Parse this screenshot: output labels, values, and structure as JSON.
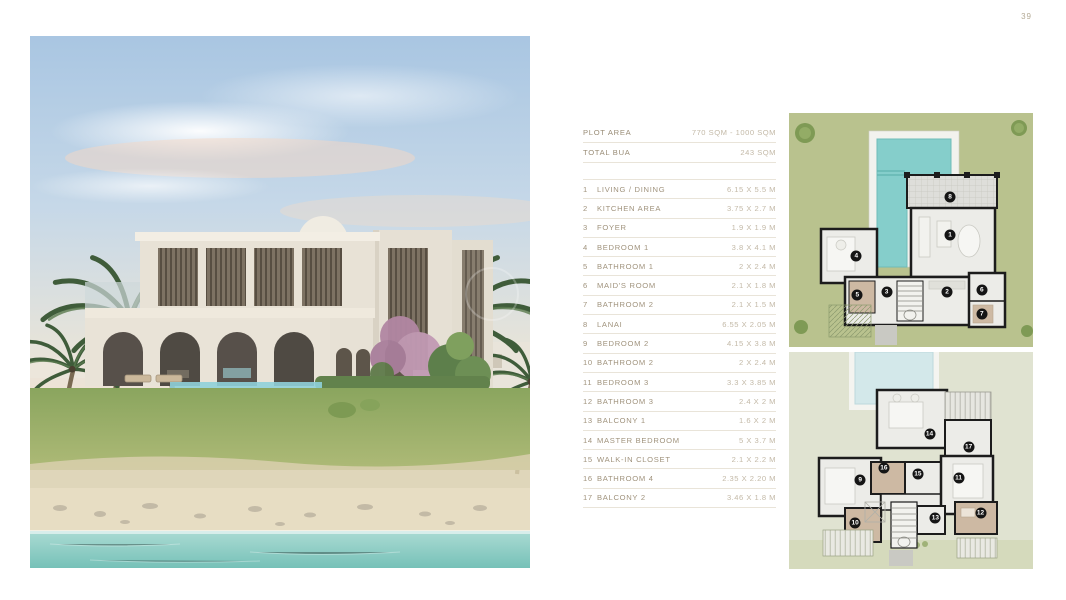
{
  "page": {
    "number": "39"
  },
  "colors": {
    "accent": "#a0937d",
    "value": "#c3b9a7",
    "divider": "#e9e4d9",
    "summary": "#998c76",
    "plan_grass": "#b9c28e",
    "plan_upper_bg": "#e0e3d1",
    "pool_teal": "#85cecb",
    "pool_pale": "#d3e8ea",
    "wall_black": "#1c1c1c",
    "water_turquoise": "#8ccbc2",
    "beach_sand": "#e7ddc3"
  },
  "spec_table": {
    "summary": [
      {
        "label": "PLOT AREA",
        "value": "770 SQM - 1000 SQM"
      },
      {
        "label": "TOTAL BUA",
        "value": "243 SQM"
      }
    ],
    "rooms": [
      {
        "num": "1",
        "label": "LIVING / DINING",
        "value": "6.15 X 5.5 M"
      },
      {
        "num": "2",
        "label": "KITCHEN AREA",
        "value": "3.75 X 2.7 M"
      },
      {
        "num": "3",
        "label": "FOYER",
        "value": "1.9 X 1.9 M"
      },
      {
        "num": "4",
        "label": "BEDROOM 1",
        "value": "3.8 X 4.1 M"
      },
      {
        "num": "5",
        "label": "BATHROOM 1",
        "value": "2 X 2.4 M"
      },
      {
        "num": "6",
        "label": "MAID'S ROOM",
        "value": "2.1 X 1.8 M"
      },
      {
        "num": "7",
        "label": "BATHROOM 2",
        "value": "2.1 X 1.5 M"
      },
      {
        "num": "8",
        "label": "LANAI",
        "value": "6.55 X 2.05 M"
      },
      {
        "num": "9",
        "label": "BEDROOM 2",
        "value": "4.15 X 3.8 M"
      },
      {
        "num": "10",
        "label": "BATHROOM 2",
        "value": "2 X 2.4 M"
      },
      {
        "num": "11",
        "label": "BEDROOM 3",
        "value": "3.3 X 3.85 M"
      },
      {
        "num": "12",
        "label": "BATHROOM 3",
        "value": "2.4 X 2 M"
      },
      {
        "num": "13",
        "label": "BALCONY 1",
        "value": "1.6 X 2 M"
      },
      {
        "num": "14",
        "label": "MASTER BEDROOM",
        "value": "5 X 3.7 M"
      },
      {
        "num": "15",
        "label": "WALK-IN CLOSET",
        "value": "2.1 X 2.2 M"
      },
      {
        "num": "16",
        "label": "BATHROOM 4",
        "value": "2.35 X 2.20 M"
      },
      {
        "num": "17",
        "label": "BALCONY 2",
        "value": "3.46 X 1.8 M"
      }
    ]
  },
  "floor_plans": {
    "ground": {
      "title": "ground-floor-plan",
      "badges": [
        {
          "n": "1",
          "x": 66.0,
          "y": 52.0
        },
        {
          "n": "2",
          "x": 64.8,
          "y": 76.3
        },
        {
          "n": "3",
          "x": 40.0,
          "y": 76.4
        },
        {
          "n": "4",
          "x": 27.6,
          "y": 61.0
        },
        {
          "n": "5",
          "x": 28.0,
          "y": 77.7
        },
        {
          "n": "6",
          "x": 79.0,
          "y": 75.8
        },
        {
          "n": "7",
          "x": 79.0,
          "y": 85.7
        },
        {
          "n": "8",
          "x": 66.0,
          "y": 36.0
        }
      ]
    },
    "first": {
      "title": "first-floor-plan",
      "badges": [
        {
          "n": "9",
          "x": 29.2,
          "y": 59.2
        },
        {
          "n": "10",
          "x": 27.1,
          "y": 78.6
        },
        {
          "n": "11",
          "x": 69.5,
          "y": 58.0
        },
        {
          "n": "12",
          "x": 78.5,
          "y": 74.3
        },
        {
          "n": "13",
          "x": 60.0,
          "y": 76.3
        },
        {
          "n": "14",
          "x": 57.6,
          "y": 37.8
        },
        {
          "n": "15",
          "x": 52.8,
          "y": 56.0
        },
        {
          "n": "16",
          "x": 38.9,
          "y": 53.4
        },
        {
          "n": "17",
          "x": 73.6,
          "y": 43.7
        }
      ]
    }
  }
}
